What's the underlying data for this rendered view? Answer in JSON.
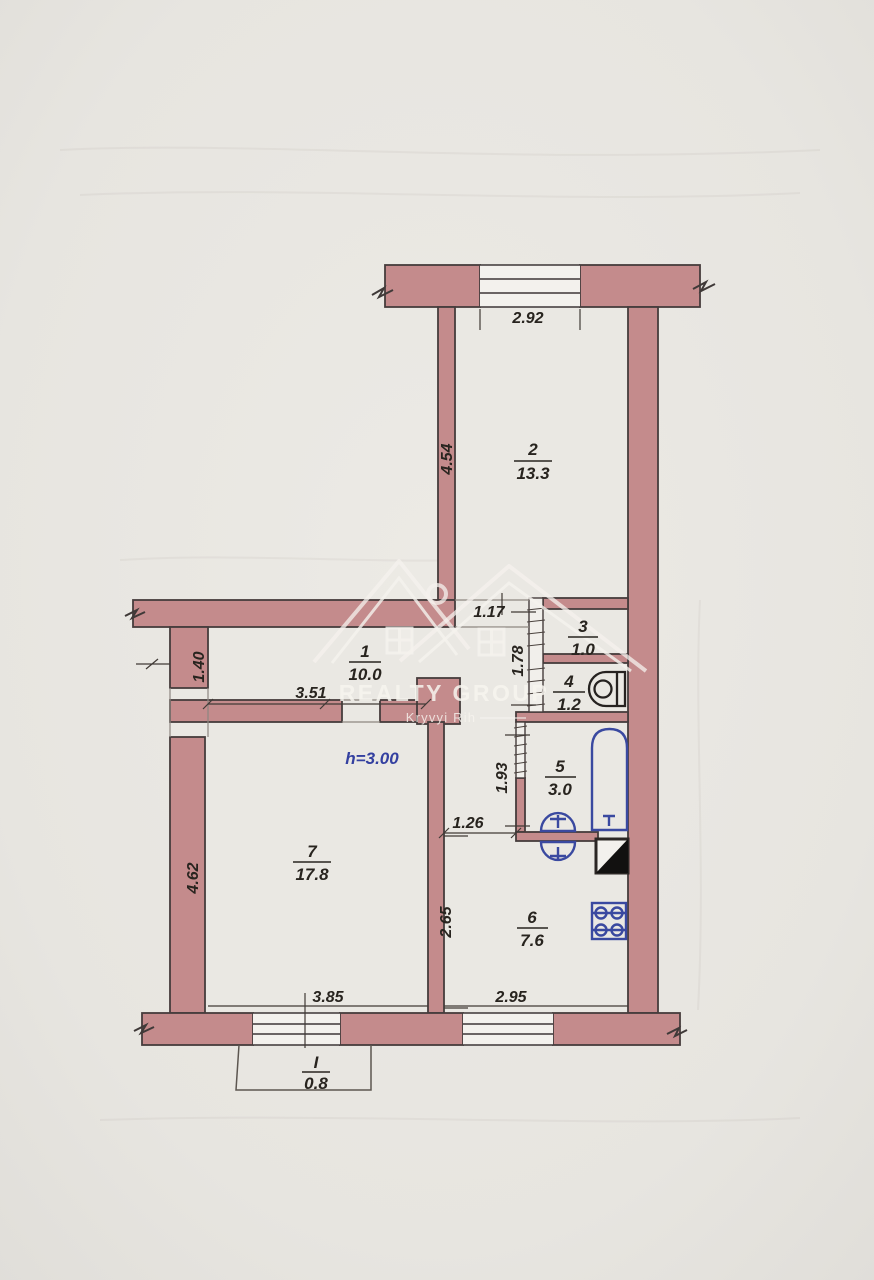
{
  "plan": {
    "watermark": {
      "brand": "REALTY GROUP",
      "city": "Kryvyi Rih"
    },
    "ceiling_note": "h=3.00",
    "rooms": [
      {
        "number": "1",
        "area": "10.0"
      },
      {
        "number": "2",
        "area": "13.3"
      },
      {
        "number": "3",
        "area": "1.0"
      },
      {
        "number": "4",
        "area": "1.2"
      },
      {
        "number": "5",
        "area": "3.0"
      },
      {
        "number": "6",
        "area": "7.6"
      },
      {
        "number": "7",
        "area": "17.8"
      },
      {
        "number": "I",
        "area": "0.8"
      }
    ],
    "dimensions": {
      "top_window": "2.92",
      "room2_depth": "4.54",
      "room2_doorway": "1.17",
      "closet_depth": "1.78",
      "entry_wall": "1.40",
      "hallway_width": "3.51",
      "bathroom_depth": "1.93",
      "corridor_width": "1.26",
      "kitchen_depth": "2.65",
      "living_depth": "4.62",
      "living_width": "3.85",
      "kitchen_width": "2.95"
    },
    "colors": {
      "wall": "#c48b8c",
      "fixture_blue": "#3a49a0",
      "note_blue": "#3440a0"
    }
  }
}
